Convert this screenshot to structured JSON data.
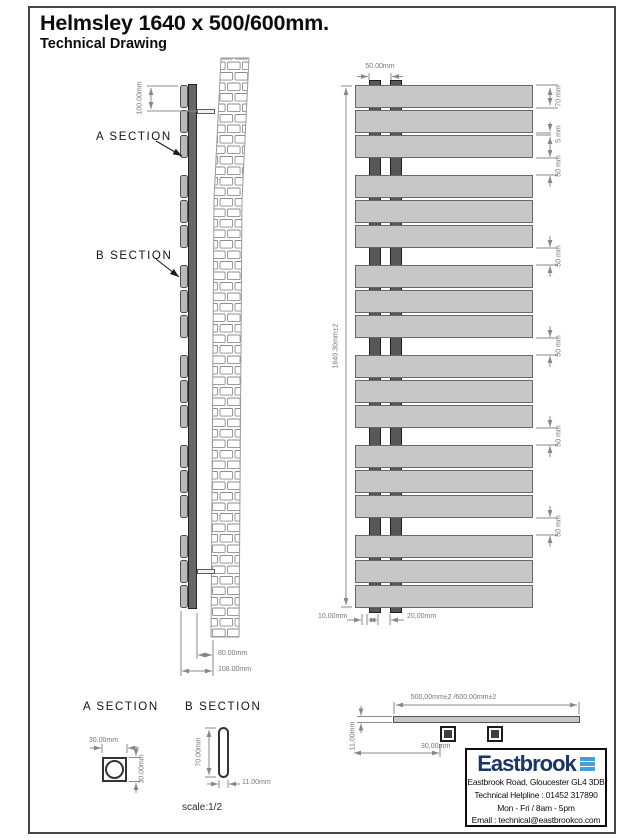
{
  "title": "Helmsley 1640 x 500/600mm.",
  "subtitle": "Technical Drawing",
  "scale_note": "scale:1/2",
  "side_view": {
    "section_a_label": "A SECTION",
    "section_b_label": "B SECTION",
    "dim_bracket_top": "100.00mm",
    "dim_wall_to_body": "80.00mm",
    "dim_wall_to_front": "108.00mm"
  },
  "front_view": {
    "panel_groups": 6,
    "panels_per_group": 3,
    "dim_tube_centres": "50.00mm",
    "dim_overall_height": "1640.30mm±2",
    "dim_panel_height": "70 mm",
    "dim_panel_gap": "5 mm",
    "dim_group_gap": "50 mm",
    "dim_bottom_offset": "10,00mm",
    "dim_tube_spacing": "20,00mm"
  },
  "section_a": {
    "title": "A SECTION",
    "dim_width": "30.00mm",
    "dim_height": "30.00mm"
  },
  "section_b": {
    "title": "B SECTION",
    "dim_height": "70.00mm",
    "dim_width": "11.00mm"
  },
  "top_view": {
    "dim_overall_width": "500,00mm±2 /600,00mm±2",
    "dim_thickness": "11,00mm",
    "dim_tube_offset": "30,00mm"
  },
  "info_box": {
    "brand": "Eastbrook",
    "address": "Eastbrook Road, Gloucester GL4 3DB",
    "helpline": "Technical Helpline : 01452 317890",
    "hours": "Mon - Fri / 8am - 5pm",
    "email": "Email : technical@eastbrookco.com"
  },
  "colors": {
    "panel_fill": "#c7c7c7",
    "tube_fill": "#575757",
    "dim_line": "#878787",
    "frame": "#454545",
    "brand_navy": "#1b3566",
    "brand_blue": "#3fa3d7"
  }
}
